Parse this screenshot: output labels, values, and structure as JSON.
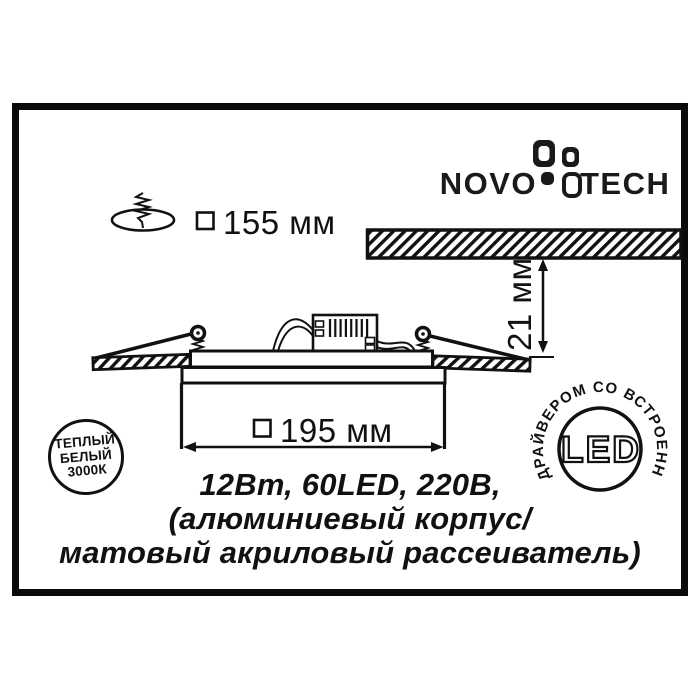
{
  "brand": {
    "name_left": "NOVO",
    "name_right": "TECH"
  },
  "dimensions": {
    "cutout_label": "155 мм",
    "body_width_label": "195 мм",
    "recess_depth_label": "21 мм"
  },
  "specs": {
    "line1": "12Вт, 60LED, 220В,",
    "line2": "(алюминиевый корпус/",
    "line3": "матовый акриловый рассеиватель)"
  },
  "badge_left": {
    "line1": "ТЕПЛЫЙ",
    "line2": "БЕЛЫЙ",
    "line3": "3000К"
  },
  "badge_right": {
    "ring_text": "ДРАЙВЕРОМ СО ВСТРОЕННЫМ",
    "center_text": "LED"
  },
  "colors": {
    "ink": "#111111",
    "background": "#ffffff"
  }
}
